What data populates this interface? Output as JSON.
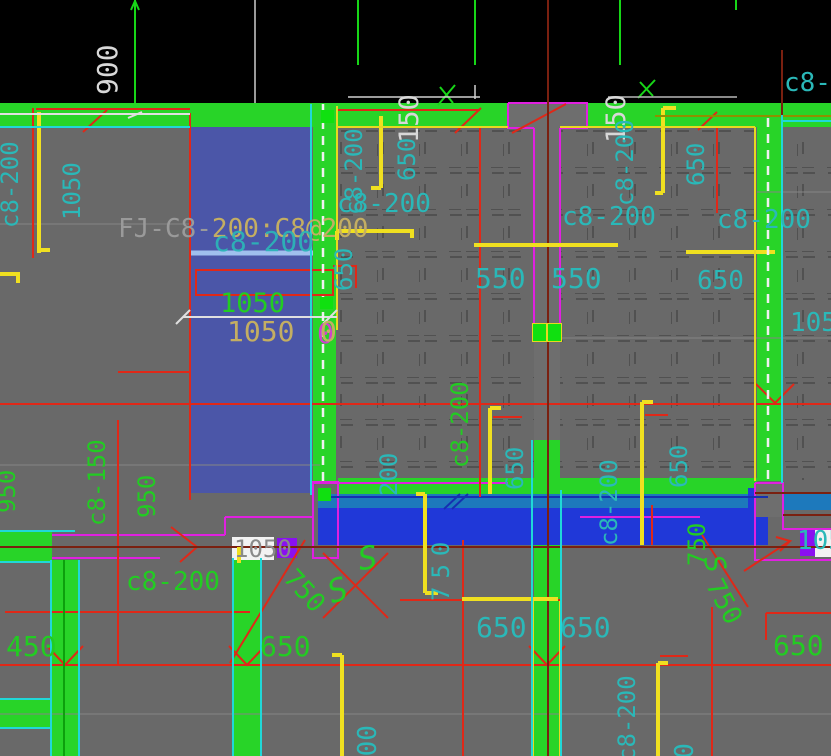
{
  "app": {
    "description": "CAD structural slab reinforcement plan view"
  },
  "palette": {
    "background_gray": "#696969",
    "paper_black": "#000000",
    "wall_green": "#28d428",
    "slab_blue": "#4b56a8",
    "beam_band_blue": "#2038d8",
    "beam_band_teal": "#1d79bc",
    "rebar_yellow": "#f0e020",
    "dim_red": "#e02818",
    "axis_dark_red": "#7a2010",
    "label_cyan": "#2ab8b8",
    "label_green": "#22cc22",
    "label_tan": "#c4ae62",
    "label_gray": "#9a9a9a",
    "boundary_magenta": "#e020e0",
    "grip_green": "#10e010",
    "grip_purple": "#8a10f0",
    "leader_blue": "#a0c0ee"
  },
  "drawing": {
    "fj_label": {
      "prefix": "FJ-C8-",
      "suffix": "200:C8@200"
    },
    "annotations": {
      "dim_900_top": "900",
      "c8_200_big": "c8-200",
      "dim_1050_green": "1050",
      "dim_1050_tan": "1050",
      "dim_0_tan": "0",
      "dim_0_mag": "0",
      "c8_200_left_v": "c8-200",
      "dim_1050_left_v": "1050",
      "c8_200_wall_v": "c8-200",
      "dim_150_left_v": "150",
      "dim_150_right_v": "150",
      "dim_650_topleft_v": "650",
      "c8_200_mid_v": "c8-200",
      "dim_650_topright_v": "650",
      "c8_2_corner": "c8-2",
      "c8_200_h1": "c8-200",
      "c8_200_h2": "c8-200",
      "c8_200_h3": "c8-200",
      "dim_650_wall_v": "650",
      "dim_550_a": "550",
      "dim_550_b": "550",
      "dim_650_right_h": "650",
      "dim_1050_right": "1050",
      "c8_200_green_v": "c8-200",
      "dim_200_teal_v": "200",
      "dim_650_band_v1": "650",
      "dim_650_band_v2": "650",
      "c8_200_band_v": "c8-200",
      "c8_150_v": "c8-150",
      "dim_950_a_v": "950",
      "dim_950_b_v": "950",
      "c8_200_green_h": "c8-200",
      "dim_1050_box": "1050",
      "dim_1050_clip_right": "1050",
      "dim_750_diag1": "750",
      "dim_750_cyan_v": "750",
      "dim_750_green_v": "750",
      "dim_750_diag2": "750",
      "s_mark1": "S",
      "s_mark2": "S",
      "s_mark3": "S",
      "dim_450": "450",
      "dim_650_bl": "650",
      "dim_650_bc1": "650",
      "dim_650_bc2": "650",
      "dim_650_br": "650",
      "dim_900_bot1_v": "900",
      "c8_200_bot_v": "c8-200",
      "dim_900_bot2_v": "900"
    }
  }
}
